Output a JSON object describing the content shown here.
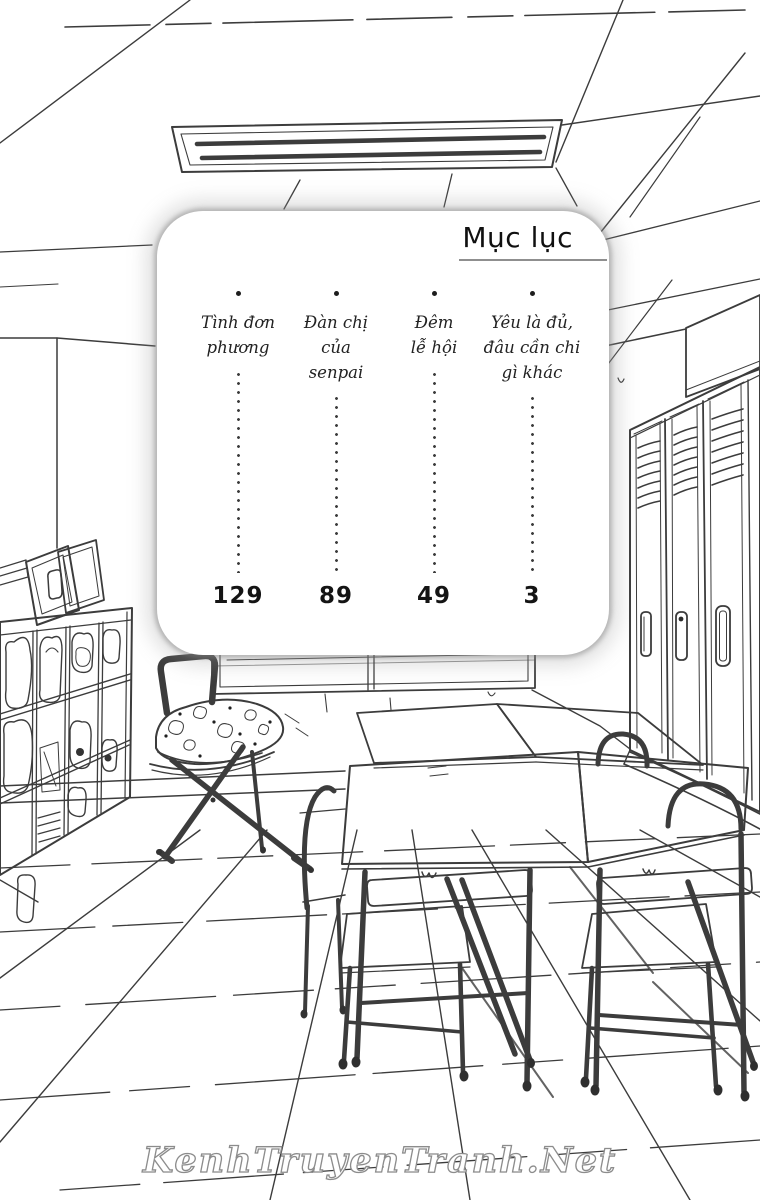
{
  "palette": {
    "paper": "#ffffff",
    "ink": "#3c3c3c",
    "halo": "#9a9a9a"
  },
  "toc": {
    "title": "Mục lục",
    "chapters": [
      {
        "title": "Tình đơn\nphương",
        "page": "129"
      },
      {
        "title": "Đàn chị\ncủa\nsenpai",
        "page": "89"
      },
      {
        "title": "Đêm\nlễ hội",
        "page": "49"
      },
      {
        "title": "Yêu là đủ,\nđâu cần chi\ngì khác",
        "page": "3"
      }
    ]
  },
  "watermark": {
    "text": "KenhTruyenTranh.Net"
  }
}
